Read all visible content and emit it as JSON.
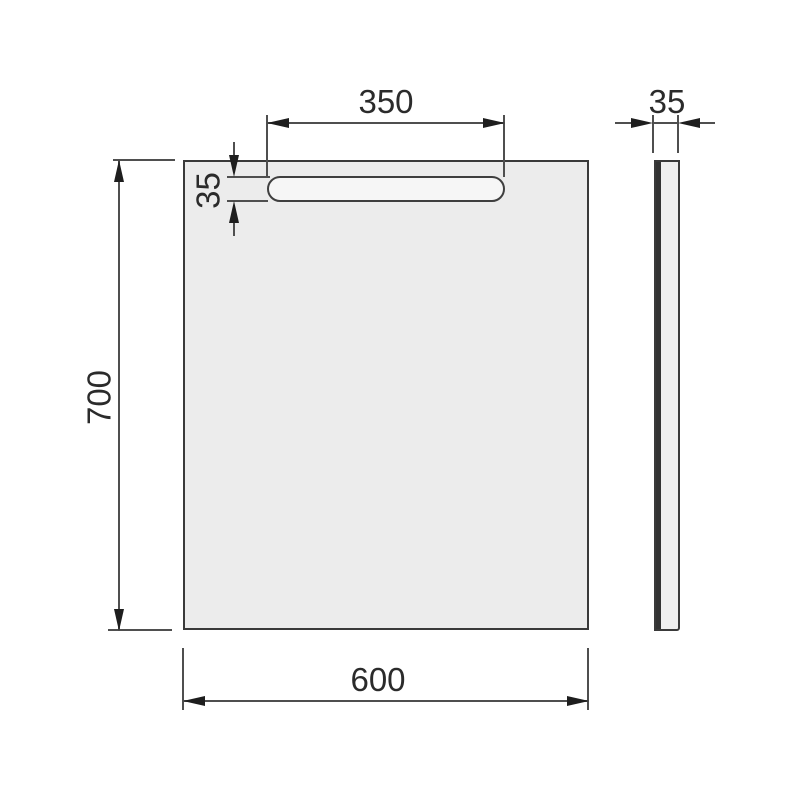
{
  "drawing": {
    "dimensions": {
      "light_bar_width": "350",
      "light_bar_height": "35",
      "panel_height": "700",
      "panel_width": "600",
      "panel_thickness": "35"
    },
    "colors": {
      "background": "#ffffff",
      "panel_fill": "#ececec",
      "light_bar_fill": "#f6f6f6",
      "side_view_fill": "#efefef",
      "outline": "#3a3a3a",
      "dimension_line": "#4f4f4f",
      "arrow": "#1e1e1e",
      "text": "#2b2b2b"
    }
  }
}
